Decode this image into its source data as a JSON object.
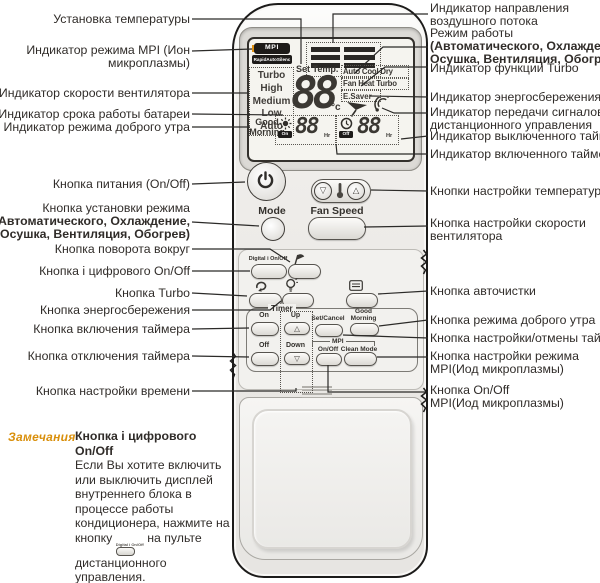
{
  "left_labels": [
    {
      "l1": "Установка температуры"
    },
    {
      "l1": "Индикатор режима MPI (Ион",
      "l2": "микроплазмы)"
    },
    {
      "l1": "Индикатор скорости вентилятора"
    },
    {
      "l1": "Индикатор срока работы батареи"
    },
    {
      "l1": "Индикатор режима доброго утра"
    },
    {
      "l1": "Кнопка питания (On/Off)"
    },
    {
      "l1": "Кнопка установки режима",
      "l2": "(Автоматического, Охлаждение,",
      "l3": "Осушка, Вентиляция, Обогрев)"
    },
    {
      "l1": "Кнопка поворота вокруг"
    },
    {
      "l1": "Кнопка i цифрового On/Off"
    },
    {
      "l1": "Кнопка Turbo"
    },
    {
      "l1": "Кнопка энергосбережения"
    },
    {
      "l1": "Кнопка включения таймера"
    },
    {
      "l1": "Кнопка отключения таймера"
    },
    {
      "l1": "Кнопка настройки времени"
    }
  ],
  "right_labels": [
    {
      "l1": "Индикатор направления",
      "l2": "воздушного потока"
    },
    {
      "l1": "Режим работы",
      "l2": "(Автоматического, Охлаждение,",
      "l3": "Осушка, Вентиляция, Обогрев)"
    },
    {
      "l1": "Индикатор функции Turbo"
    },
    {
      "l1": "Индикатор энергосбережения"
    },
    {
      "l1": "Индикатор передачи сигналов",
      "l2": "дистанционного управления"
    },
    {
      "l1": "Индикатор выключенного таймера"
    },
    {
      "l1": "Индикатор включенного таймера"
    },
    {
      "l1": "Кнопки настройки температуры"
    },
    {
      "l1": "Кнопка настройки скорости",
      "l2": "вентилятора"
    },
    {
      "l1": "Кнопка авточистки"
    },
    {
      "l1": "Кнопка режима доброго утра"
    },
    {
      "l1": "Кнопка настройки/отмены таймера"
    },
    {
      "l1": "Кнопка настройки режима",
      "l2": "MPI(Иод микроплазмы)"
    },
    {
      "l1": "Кнопка On/Off",
      "l2": "MPI(Иод микроплазмы)"
    }
  ],
  "remote": {
    "display": {
      "mpi_badge": "MPI",
      "rapid_badge": "RapidAutoSilenc",
      "fan_speeds": [
        "Turbo",
        "High",
        "Medium",
        "Low",
        "Auto"
      ],
      "set_temp_label": "Set Temp.",
      "temp_value": "88",
      "temp_unit": "°c",
      "mode_row_1": "Auto Cool Dry",
      "mode_row_2": "Fan Heat Turbo",
      "mode_row_3": "E.Saver",
      "good_morning_1": "Good",
      "good_morning_2": "Morning",
      "timer_on_badge": "On",
      "timer_on_value": "88",
      "timer_off_badge": "Off",
      "timer_off_value": "88",
      "timer_unit": "Hr"
    },
    "buttons": {
      "mode": "Mode",
      "fan_speed": "Fan Speed",
      "digital": "Digital i On/Off",
      "timer": "Timer",
      "on": "On",
      "up": "Up",
      "up_glyph": "△",
      "set_cancel": "Set/Cancel",
      "good_morning_1": "Good",
      "good_morning_2": "Morning",
      "off": "Off",
      "down": "Down",
      "down_glyph": "▽",
      "mpi": "MPI",
      "mpi_onoff": "On/Off",
      "clean_mode": "Clean Mode",
      "temp_down_glyph": "▽",
      "temp_up_glyph": "△"
    }
  },
  "note": {
    "heading": "Замечания",
    "title": "Кнопка i цифрового On/Off",
    "body_before": "Если Вы хотите включить или выключить дисплей внутреннего блока в процессе работы кондиционера, нажмите на кнопку",
    "inline_button_label": "Digital i On/Off",
    "body_after": "на пульте дистанционного управления."
  },
  "colors": {
    "accent_orange": "#e09112",
    "callout_line": "#2b2a28",
    "lcd_segment": "#3b3833"
  }
}
